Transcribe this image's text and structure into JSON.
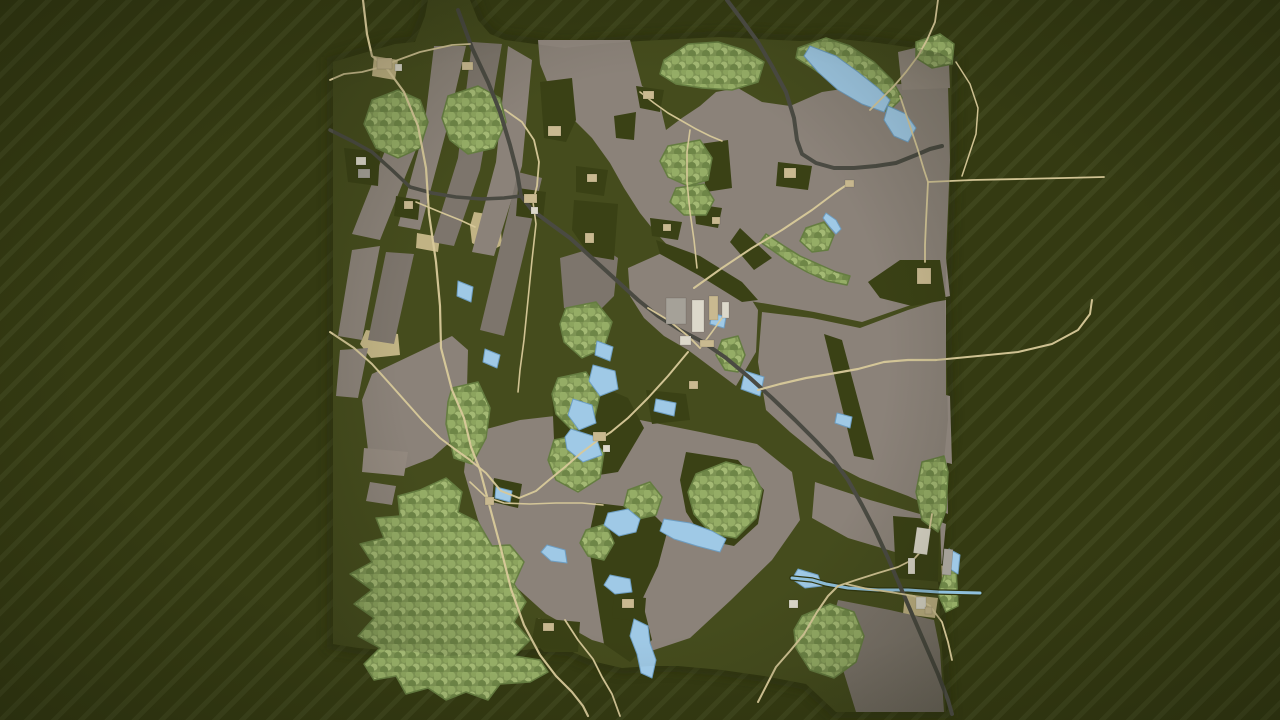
{
  "scene": {
    "width": 1280,
    "height": 720,
    "background": {
      "base": "#343a12",
      "stripe": "#3e451c",
      "stripe_width": 5,
      "period": 19,
      "direction": "diagonal-ne"
    },
    "map_polygon": "333,62 360,54 395,44 415,42 425,16 428,0 470,0 478,20 490,34 505,40 535,44 565,48 600,44 640,41 680,39 720,37 758,39 800,41 840,39 878,43 915,48 940,53 952,60 950,180 945,300 948,420 940,500 938,580 942,650 946,712 836,712 806,684 764,676 722,670 678,666 650,666 622,668 596,662 568,650 540,648 510,652 478,654 448,656 415,652 385,650 358,648 333,644"
  },
  "palette": {
    "map_base": "#454c1d",
    "map_edge_shadow": "#262b0d",
    "field_tones": [
      "#8b8279",
      "#7d756c",
      "#93897f"
    ],
    "green_patch": "#3a4115",
    "forest_base": "#7e9454",
    "forest_dots": [
      "#95ad66",
      "#a4b974",
      "#6e8647",
      "#8ca45e"
    ],
    "forest_edge": "#657d41",
    "lake_fill": "#9fc9e6",
    "lake_edge": "#6e9ec2",
    "river_water": "#8fc0dc",
    "river_bank": "#30360f",
    "road_tan": "#d8c99a",
    "road_dark": "#4a4a42",
    "dirt": "#c8b88a",
    "building_light": "#dcd8ca",
    "building_tan": "#c9b990",
    "building_gray": "#a5a198",
    "vignette": "rgba(10,12,4,0.28)"
  },
  "features": {
    "fields": [
      {
        "tone": 0,
        "points": "398,118 427,122 380,240 352,234"
      },
      {
        "tone": 0,
        "points": "434,46 466,46 446,132 420,230 398,226 424,130"
      },
      {
        "tone": 1,
        "points": "472,42 502,44 480,170 454,246 432,242 458,158"
      },
      {
        "tone": 0,
        "points": "508,46 532,60 522,166 494,256 472,252 496,162"
      },
      {
        "tone": 1,
        "points": "518,172 542,178 504,336 480,330"
      },
      {
        "tone": 0,
        "points": "352,250 380,246 362,340 338,336"
      },
      {
        "tone": 1,
        "points": "386,252 414,254 394,344 368,340"
      },
      {
        "tone": 0,
        "points": "340,350 368,348 358,398 336,396"
      },
      {
        "tone": 0,
        "points": "372,374 452,336 468,350 466,428 432,458 396,472 368,450 362,400"
      },
      {
        "tone": 2,
        "points": "364,448 408,452 404,476 362,472"
      },
      {
        "tone": 0,
        "points": "370,482 396,486 392,505 366,501"
      },
      {
        "tone": 0,
        "points": "538,40 630,40 642,86 658,96 666,130 682,118 700,106 716,92 738,88 762,102 790,106 822,92 862,86 902,84 948,86 950,160 946,258 950,296 908,306 862,322 814,312 768,304 737,299 715,289 700,279 688,267 672,250 656,233 640,213 624,188 610,163 592,138 572,118 552,94 540,64"
      },
      {
        "tone": 0,
        "points": "628,268 664,252 694,262 724,278 748,294 758,310 756,352 736,386 712,368 688,350 664,336 644,318 630,296"
      },
      {
        "tone": 1,
        "points": "560,258 600,246 618,258 614,296 592,318 564,308"
      },
      {
        "tone": 0,
        "points": "762,312 812,318 860,328 908,310 946,298 946,420 948,514 908,496 860,478 822,458 790,432 766,410 758,362"
      },
      {
        "tone": 0,
        "points": "468,434 520,420 572,414 640,420 700,432 757,444 792,472 800,520 772,560 731,600 690,638 642,654 592,640 546,614 506,578 478,520 464,472"
      },
      {
        "tone": 0,
        "points": "815,482 870,500 920,514 946,524 942,564 895,552 848,538 812,518"
      },
      {
        "tone": 1,
        "points": "838,600 890,610 934,620 940,650 944,712 856,712 840,660 832,622"
      },
      {
        "tone": 0,
        "points": "925,390 950,396 952,464 928,458"
      },
      {
        "tone": 2,
        "points": "898,52 948,40 950,88 902,90"
      }
    ],
    "green_patches": [
      {
        "points": "540,82 572,78 576,120 566,142 544,138"
      },
      {
        "points": "614,116 636,112 634,140 616,138"
      },
      {
        "points": "576,166 608,170 604,196 576,192"
      },
      {
        "points": "574,200 618,204 614,260 590,256 572,230"
      },
      {
        "points": "650,218 682,222 678,240 652,236"
      },
      {
        "points": "694,204 722,208 718,228 696,224"
      },
      {
        "points": "700,144 728,140 732,188 706,192"
      },
      {
        "points": "740,228 772,258 754,270 730,242"
      },
      {
        "points": "636,86 664,90 660,112 640,108"
      },
      {
        "points": "824,334 842,340 874,460 854,456"
      },
      {
        "points": "552,392 600,386 628,398 644,428 618,472 580,478 554,440"
      },
      {
        "points": "596,503 648,509 668,529 658,566 642,600 652,640 630,662 604,644 594,580 588,540"
      },
      {
        "points": "686,452 738,460 764,490 758,524 734,546 704,540 686,512 680,480"
      },
      {
        "points": "536,618 580,622 578,652 544,652 532,640"
      },
      {
        "points": "494,478 522,484 518,508 492,502"
      },
      {
        "points": "646,390 686,394 690,420 652,424"
      },
      {
        "points": "868,282 900,260 940,260 946,300 912,306 880,298"
      },
      {
        "points": "656,240 700,256 742,282 758,300 742,302 700,276 660,254"
      },
      {
        "points": "344,148 380,152 378,186 348,182"
      },
      {
        "points": "396,196 420,200 418,220 394,216"
      },
      {
        "points": "518,188 546,192 543,220 516,216"
      },
      {
        "points": "778,162 812,166 808,190 776,186"
      },
      {
        "points": "614,594 646,598 644,622 612,618"
      },
      {
        "points": "893,516 940,520 942,582 896,578"
      }
    ],
    "forests": [
      {
        "points": "372,100 398,90 420,100 428,122 420,148 398,158 376,148 364,124"
      },
      {
        "points": "448,96 478,86 500,98 506,122 494,148 468,154 450,140 442,118"
      },
      {
        "points": "452,388 478,382 490,408 486,438 472,464 454,458 446,424 448,402"
      },
      {
        "points": "664,60 688,44 718,42 744,50 764,62 758,82 732,90 702,88 676,84 660,74"
      },
      {
        "points": "798,48 826,38 850,46 874,62 892,80 902,98 888,112 864,100 838,86 812,68 796,58"
      },
      {
        "points": "916,42 940,34 954,44 952,64 932,68 916,58"
      },
      {
        "points": "566,308 596,302 612,322 604,348 582,358 564,342 560,324"
      },
      {
        "points": "558,378 586,372 600,394 594,420 574,432 556,414 552,394"
      },
      {
        "points": "554,440 584,434 604,452 600,478 578,492 556,480 548,460"
      },
      {
        "points": "420,490 446,478 462,492 458,512 478,522 492,546 510,545 524,562 514,584 526,602 514,622 530,640 514,656 540,660 548,672 530,682 500,684 488,700 466,692 446,700 428,688 406,694 396,676 374,680 364,664 380,648 358,636 374,618 354,604 372,590 350,574 372,562 360,544 384,538 376,518 400,516 398,496"
      },
      {
        "points": "696,474 726,462 750,468 762,490 756,518 736,538 712,534 694,514 688,492"
      },
      {
        "points": "802,616 830,604 854,612 864,636 856,662 834,678 810,670 796,648 794,630"
      },
      {
        "points": "922,462 944,456 948,472 946,510 938,532 922,520 916,492"
      },
      {
        "points": "628,490 650,482 662,497 656,515 638,519 624,506"
      },
      {
        "points": "586,530 606,524 614,543 604,560 588,556 580,543"
      },
      {
        "points": "722,340 738,336 745,355 738,372 725,370 716,355"
      },
      {
        "points": "806,228 824,222 834,235 828,250 812,252 800,241"
      },
      {
        "points": "668,146 700,140 712,158 708,180 688,186 668,177 660,161"
      },
      {
        "points": "676,188 704,184 714,200 706,215 684,215 670,202"
      },
      {
        "points": "766,234 784,246 800,256 818,264 836,272 850,276 847,285 827,281 807,272 789,262 772,250 760,242"
      },
      {
        "points": "944,574 956,568 958,606 946,612 938,594"
      }
    ],
    "lakes": [
      {
        "points": "810,46 836,56 858,72 878,88 890,100 884,112 862,104 838,90 818,72 804,56"
      },
      {
        "points": "888,106 906,114 916,128 908,142 894,136 884,120"
      },
      {
        "points": "826,213 836,220 841,229 836,234 829,226 823,218"
      },
      {
        "points": "458,281 473,287 471,302 457,296"
      },
      {
        "points": "485,349 500,355 497,368 483,362"
      },
      {
        "points": "597,341 613,347 610,361 595,355"
      },
      {
        "points": "593,365 615,371 618,389 600,396 589,381"
      },
      {
        "points": "573,399 592,405 596,423 579,430 568,415"
      },
      {
        "points": "571,429 596,437 602,455 583,462 567,449 565,437"
      },
      {
        "points": "712,313 726,317 724,328 710,324"
      },
      {
        "points": "745,371 764,377 760,396 741,389"
      },
      {
        "points": "656,399 676,403 674,416 654,411"
      },
      {
        "points": "664,519 690,523 712,531 726,539 720,552 697,546 674,539 660,531"
      },
      {
        "points": "608,513 628,509 640,519 636,532 619,536 604,525"
      },
      {
        "points": "610,575 630,579 632,592 615,594 604,585"
      },
      {
        "points": "634,619 648,626 650,643 656,660 652,678 641,673 637,654 630,636"
      },
      {
        "points": "547,545 565,550 567,563 551,561 541,552"
      },
      {
        "points": "496,487 512,491 510,502 495,498"
      },
      {
        "points": "798,569 818,575 822,586 805,588 792,579"
      },
      {
        "points": "949,549 960,555 958,574 947,567"
      },
      {
        "points": "837,413 852,417 850,428 835,423"
      }
    ],
    "rivers": [
      {
        "w": 3,
        "points": "792,578 812,580 826,584 848,588 878,590 908,590 938,592 980,593"
      }
    ],
    "dirt_patches": [
      {
        "points": "474,212 500,216 502,245 489,252 472,243 470,226"
      },
      {
        "points": "366,330 398,334 400,355 371,358 360,344"
      },
      {
        "points": "538,618 562,622 560,645 536,642"
      },
      {
        "points": "616,596 644,600 642,620 614,617"
      },
      {
        "points": "417,233 440,237 438,252 416,248"
      },
      {
        "points": "684,296 728,302 724,334 688,330"
      },
      {
        "points": "676,316 692,320 690,344 674,340"
      },
      {
        "points": "914,264 934,268 932,290 912,286"
      },
      {
        "points": "590,430 616,434 613,456 588,452"
      },
      {
        "points": "352,154 378,158 375,184 350,180"
      },
      {
        "points": "521,191 543,195 540,218 518,214"
      },
      {
        "points": "374,56 398,60 395,80 372,76"
      },
      {
        "points": "640,90 660,93 658,110 639,107"
      },
      {
        "points": "482,494 505,498 503,512 480,508"
      },
      {
        "points": "908,556 922,559 920,580 906,577"
      },
      {
        "points": "930,563 944,566 942,580 929,578"
      },
      {
        "points": "782,166 802,170 799,188 780,185"
      },
      {
        "points": "905,594 938,598 935,618 903,614"
      }
    ],
    "roads_dark": [
      {
        "w": 4,
        "points": "458,10 472,48 488,82 500,112 510,145 517,172 521,196 532,210 548,222 570,238 592,258 614,278 638,300 658,316 680,330 703,342 726,358 750,378 772,398 795,420 815,440 832,458 848,480 862,505 875,530 888,558 900,586 912,614 925,644 938,674 948,700 952,714"
      },
      {
        "w": 4,
        "points": "727,0 742,20 758,42 772,66 786,92 794,118 797,140 802,154 816,163 834,168 854,168 876,166 896,163 916,155 930,149 942,146"
      },
      {
        "w": 3.5,
        "points": "330,130 352,141 372,152 392,170 410,187 432,193 456,197 482,199 504,198 521,196"
      }
    ],
    "roads_tan": [
      {
        "w": 2.2,
        "points": "363,0 367,34 372,56 385,66 404,92 418,126 426,168 429,214 436,262 440,306 441,348 452,390 464,418 471,447 480,470 489,504 500,545 511,589 524,625 540,655 556,676 572,692 583,706 588,716"
      },
      {
        "w": 1.8,
        "points": "385,66 362,72 344,74 330,80"
      },
      {
        "w": 1.8,
        "points": "387,64 420,52 452,45 470,44"
      },
      {
        "w": 2,
        "points": "330,332 354,348 372,364 390,384 406,402 422,420 440,438 456,450 470,460"
      },
      {
        "w": 2,
        "points": "694,288 722,268 752,248 782,230 812,210 836,192 848,184"
      },
      {
        "w": 2.2,
        "points": "758,390 780,384 806,378 830,374 858,369 884,362 908,360 936,360"
      },
      {
        "w": 2,
        "points": "936,360 978,356 1018,352 1052,344 1078,330 1090,314 1092,300"
      },
      {
        "w": 1.8,
        "points": "928,182 972,180 1020,179 1064,178 1104,177"
      },
      {
        "w": 1.8,
        "points": "900,96 908,120 918,150 924,170 928,182 926,222 925,245 925,262"
      },
      {
        "w": 2,
        "points": "758,702 776,667 790,651 804,634 817,612 828,596 838,586"
      },
      {
        "w": 1.8,
        "points": "838,586 856,580 878,573 898,567 914,559 924,548 929,532 932,514"
      },
      {
        "w": 1.8,
        "points": "846,584 868,589 890,592 914,596 930,606 942,622 948,642 952,660"
      },
      {
        "w": 1.8,
        "points": "505,110 522,122 534,140 539,162 537,186 533,202"
      },
      {
        "w": 1.6,
        "points": "533,202 536,224 532,260 528,300 524,340 520,370 518,392"
      },
      {
        "w": 2,
        "points": "688,352 668,376 648,398 628,418 611,432 597,441 581,453 565,467 549,480 536,491 519,498 501,491 486,473 471,461"
      },
      {
        "w": 1.8,
        "points": "648,308 668,320 688,336 700,348"
      },
      {
        "w": 1.8,
        "points": "938,0 935,22 927,40 918,56 906,72 894,86 880,100 870,110"
      },
      {
        "w": 1.6,
        "points": "697,268 694,240 690,212 687,182 687,152 690,130"
      },
      {
        "w": 1.6,
        "points": "640,92 654,103 668,113 682,121 696,129 710,136 722,141"
      },
      {
        "w": 1.6,
        "points": "416,202 440,212 460,220 475,227"
      },
      {
        "w": 1.6,
        "points": "470,482 486,497 504,503 530,504 556,503 582,503 603,505"
      },
      {
        "w": 1.8,
        "points": "565,620 578,640 593,659 602,677 612,694 620,716"
      },
      {
        "w": 1.6,
        "points": "700,348 712,332 722,318"
      },
      {
        "w": 1.5,
        "points": "956,62 970,84 978,108 976,134 968,158 962,176"
      }
    ],
    "buildings": [
      {
        "x": 666,
        "y": 298,
        "w": 20,
        "h": 26,
        "rot": 0,
        "type": "g"
      },
      {
        "x": 692,
        "y": 300,
        "w": 12,
        "h": 32,
        "rot": 0,
        "type": "l"
      },
      {
        "x": 709,
        "y": 296,
        "w": 9,
        "h": 24,
        "rot": 0,
        "type": "t"
      },
      {
        "x": 680,
        "y": 336,
        "w": 11,
        "h": 9,
        "rot": 0,
        "type": "l"
      },
      {
        "x": 700,
        "y": 340,
        "w": 14,
        "h": 7,
        "rot": 0,
        "type": "t"
      },
      {
        "x": 722,
        "y": 302,
        "w": 7,
        "h": 16,
        "rot": 0,
        "type": "l"
      },
      {
        "x": 377,
        "y": 58,
        "w": 15,
        "h": 11,
        "rot": 0,
        "type": "t"
      },
      {
        "x": 395,
        "y": 64,
        "w": 7,
        "h": 7,
        "rot": 0,
        "type": "l"
      },
      {
        "x": 524,
        "y": 194,
        "w": 13,
        "h": 9,
        "rot": 0,
        "type": "t"
      },
      {
        "x": 531,
        "y": 207,
        "w": 7,
        "h": 7,
        "rot": 0,
        "type": "l"
      },
      {
        "x": 462,
        "y": 62,
        "w": 11,
        "h": 8,
        "rot": 0,
        "type": "t"
      },
      {
        "x": 593,
        "y": 432,
        "w": 13,
        "h": 9,
        "rot": 0,
        "type": "t"
      },
      {
        "x": 603,
        "y": 445,
        "w": 7,
        "h": 7,
        "rot": 0,
        "type": "l"
      },
      {
        "x": 543,
        "y": 623,
        "w": 11,
        "h": 8,
        "rot": 0,
        "type": "t"
      },
      {
        "x": 485,
        "y": 497,
        "w": 9,
        "h": 8,
        "rot": 0,
        "type": "t"
      },
      {
        "x": 915,
        "y": 528,
        "w": 14,
        "h": 26,
        "rot": 8,
        "type": "l"
      },
      {
        "x": 943,
        "y": 549,
        "w": 9,
        "h": 26,
        "rot": 5,
        "type": "g"
      },
      {
        "x": 908,
        "y": 558,
        "w": 7,
        "h": 16,
        "rot": 0,
        "type": "l"
      },
      {
        "x": 916,
        "y": 597,
        "w": 10,
        "h": 12,
        "rot": 0,
        "type": "l"
      },
      {
        "x": 925,
        "y": 607,
        "w": 7,
        "h": 7,
        "rot": 0,
        "type": "t"
      },
      {
        "x": 917,
        "y": 268,
        "w": 14,
        "h": 16,
        "rot": 0,
        "type": "t"
      },
      {
        "x": 784,
        "y": 168,
        "w": 12,
        "h": 10,
        "rot": 0,
        "type": "t"
      },
      {
        "x": 548,
        "y": 126,
        "w": 13,
        "h": 10,
        "rot": 0,
        "type": "t"
      },
      {
        "x": 689,
        "y": 381,
        "w": 9,
        "h": 8,
        "rot": 0,
        "type": "t"
      },
      {
        "x": 587,
        "y": 174,
        "w": 10,
        "h": 8,
        "rot": 0,
        "type": "t"
      },
      {
        "x": 585,
        "y": 233,
        "w": 9,
        "h": 10,
        "rot": 0,
        "type": "t"
      },
      {
        "x": 643,
        "y": 91,
        "w": 11,
        "h": 8,
        "rot": 0,
        "type": "t"
      },
      {
        "x": 356,
        "y": 157,
        "w": 10,
        "h": 8,
        "rot": 0,
        "type": "l"
      },
      {
        "x": 358,
        "y": 169,
        "w": 12,
        "h": 9,
        "rot": 0,
        "type": "g"
      },
      {
        "x": 404,
        "y": 201,
        "w": 9,
        "h": 8,
        "rot": 0,
        "type": "t"
      },
      {
        "x": 622,
        "y": 599,
        "w": 12,
        "h": 9,
        "rot": 0,
        "type": "t"
      },
      {
        "x": 789,
        "y": 600,
        "w": 9,
        "h": 8,
        "rot": 0,
        "type": "l"
      },
      {
        "x": 845,
        "y": 180,
        "w": 9,
        "h": 7,
        "rot": 0,
        "type": "t"
      },
      {
        "x": 712,
        "y": 217,
        "w": 8,
        "h": 7,
        "rot": 0,
        "type": "t"
      },
      {
        "x": 663,
        "y": 224,
        "w": 8,
        "h": 7,
        "rot": 0,
        "type": "t"
      }
    ]
  }
}
